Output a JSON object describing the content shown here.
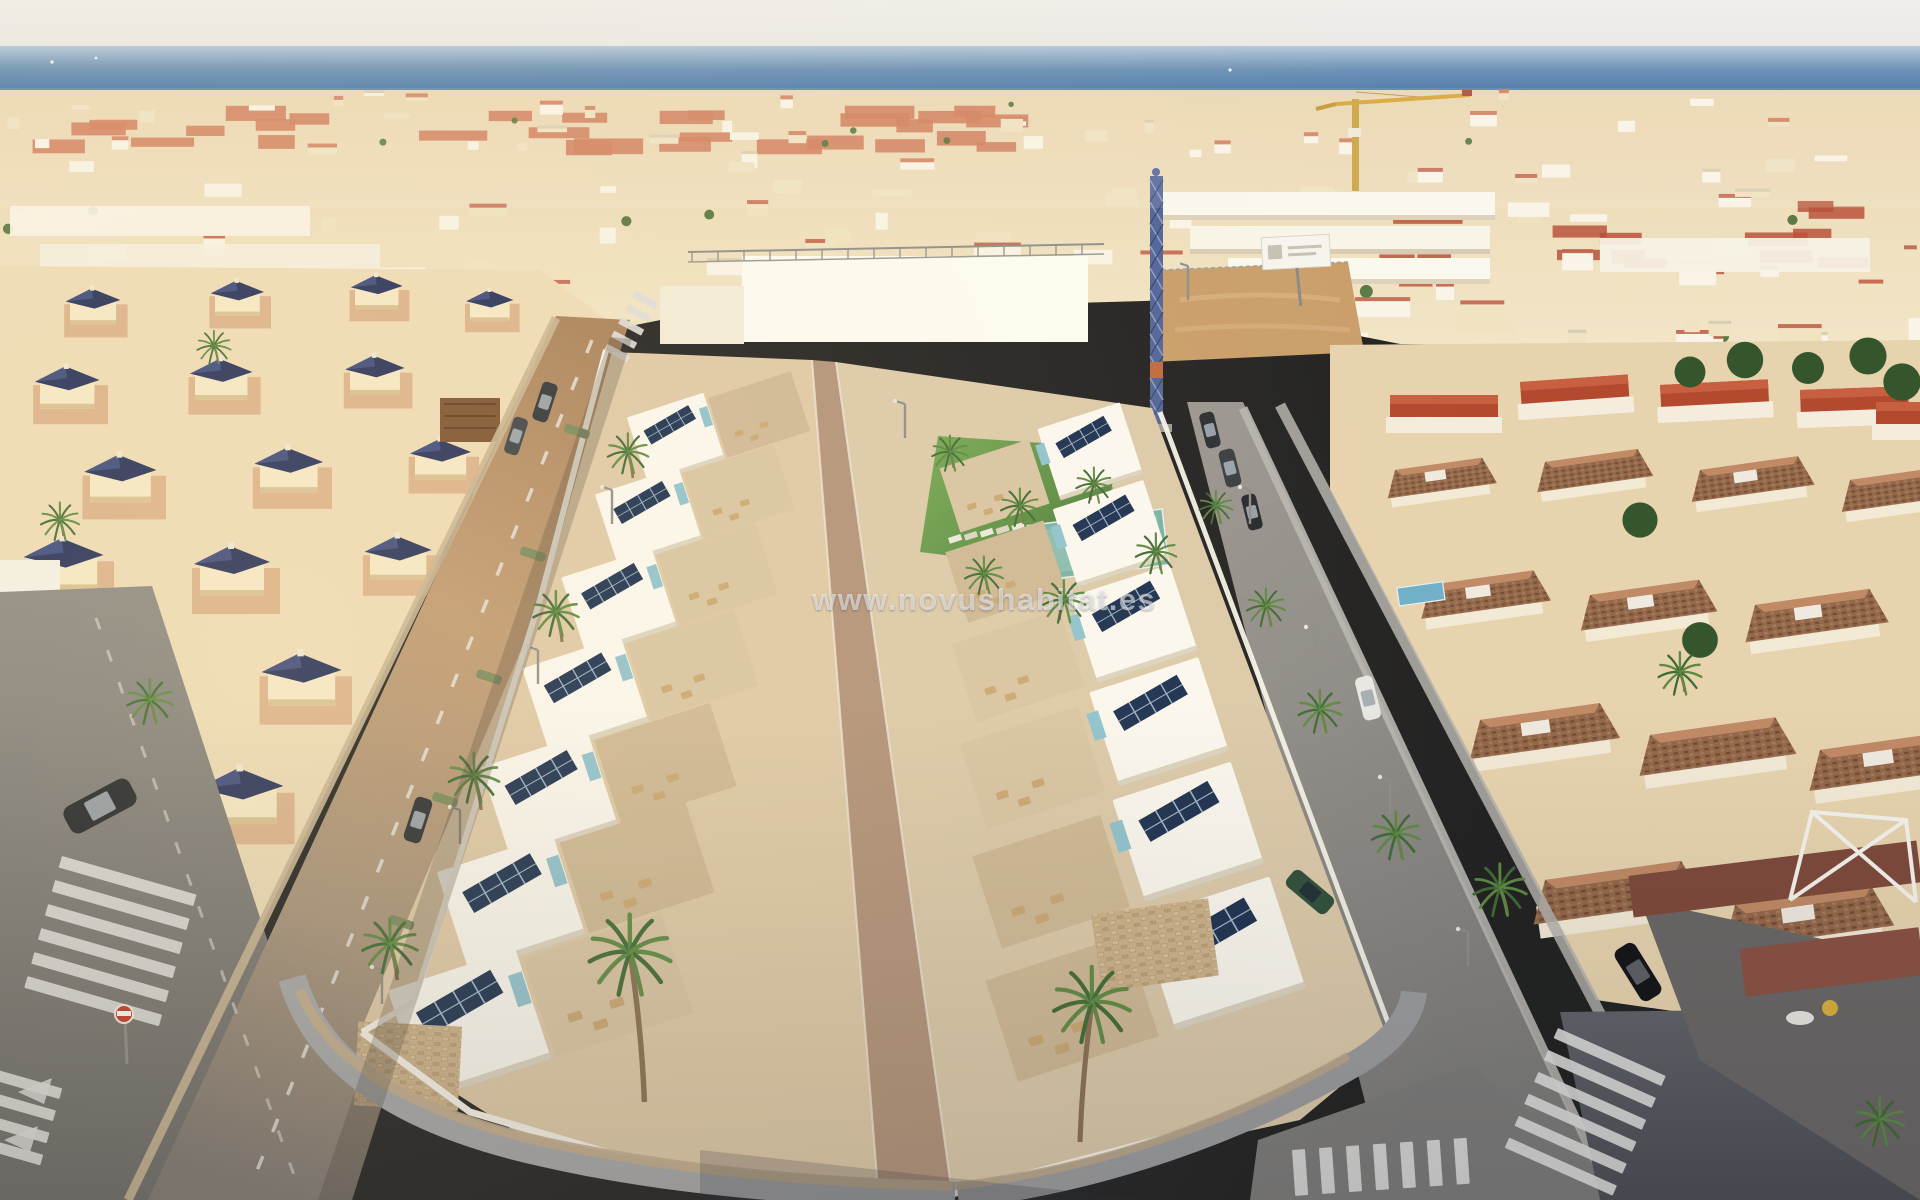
{
  "watermark": {
    "text": "www.novushabitat.es"
  },
  "palette": {
    "sky": "#ebe9e5",
    "sea_deep": "#33669f",
    "sea_light": "#7fa3c6",
    "sand": "#dcc69e",
    "town_base": "#ead7b2",
    "roof_red": "#cf7a58",
    "roof_navy": "#27325b",
    "roof_terra": "#b3492f",
    "tile_brown": "#94684a",
    "villa_white": "#fbf8f0",
    "terrace_tan": "#d9c5a4",
    "walk_brown": "#b2937a",
    "solar_navy": "#1b3050",
    "glass_teal": "#8fc3cf",
    "lawn_green": "#5f9347",
    "pool_teal": "#79b2a6",
    "palm_green": "#3f6b34",
    "palm_trunk": "#8a6f52",
    "road_warm": "#bf9a74",
    "road_grey": "#7a7a78",
    "road_dark": "#55565a",
    "sidewalk_grey": "#a7a8aa",
    "pave_warm": "#c5ad8c",
    "wall_white": "#f7f3e9",
    "crane_blue": "#51649a",
    "crane_yellow": "#d8a435",
    "sign_red": "#c23b28",
    "car_dark": "#23272b"
  }
}
